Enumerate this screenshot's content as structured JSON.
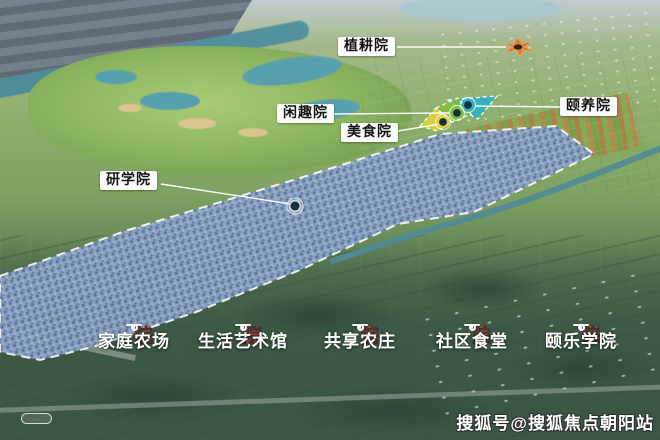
{
  "callouts": [
    {
      "label": "植耕院"
    },
    {
      "label": "闲趣院"
    },
    {
      "label": "美食院"
    },
    {
      "label": "颐养院"
    },
    {
      "label": "研学院"
    }
  ],
  "legend": [
    {
      "chars": [
        "植",
        "耕",
        "院"
      ],
      "subtitle": "家庭农场"
    },
    {
      "chars": [
        "颐",
        "养",
        "院"
      ],
      "subtitle": "生活艺术馆"
    },
    {
      "chars": [
        "闲",
        "趣",
        "院"
      ],
      "subtitle": "共享农庄"
    },
    {
      "chars": [
        "美",
        "食",
        "院"
      ],
      "subtitle": "社区食堂"
    },
    {
      "chars": [
        "研",
        "学",
        "院"
      ],
      "subtitle": "颐乐学院"
    }
  ],
  "watermark": "搜狐号@搜狐焦点朝阳站",
  "markers": [
    {
      "name": "orange-flower-marker",
      "color": "#e0762b"
    },
    {
      "name": "teal-ring-marker",
      "color": "#2fb3c4"
    },
    {
      "name": "green-ring-marker",
      "color": "#7fbf3f"
    },
    {
      "name": "yellow-ring-marker",
      "color": "#e6d13c"
    },
    {
      "name": "gray-ring-marker",
      "color": "#c7d3da"
    }
  ],
  "colors": {
    "legend_accent_red": "#b5382a",
    "legend_text_dark": "#383838",
    "zone_teal": "#2fb3c4",
    "zone_green": "#7fbf3f",
    "zone_yellow": "#e6d13c",
    "marker_orange": "#e0762b",
    "residential_band_blue": "#8ca3c4"
  }
}
